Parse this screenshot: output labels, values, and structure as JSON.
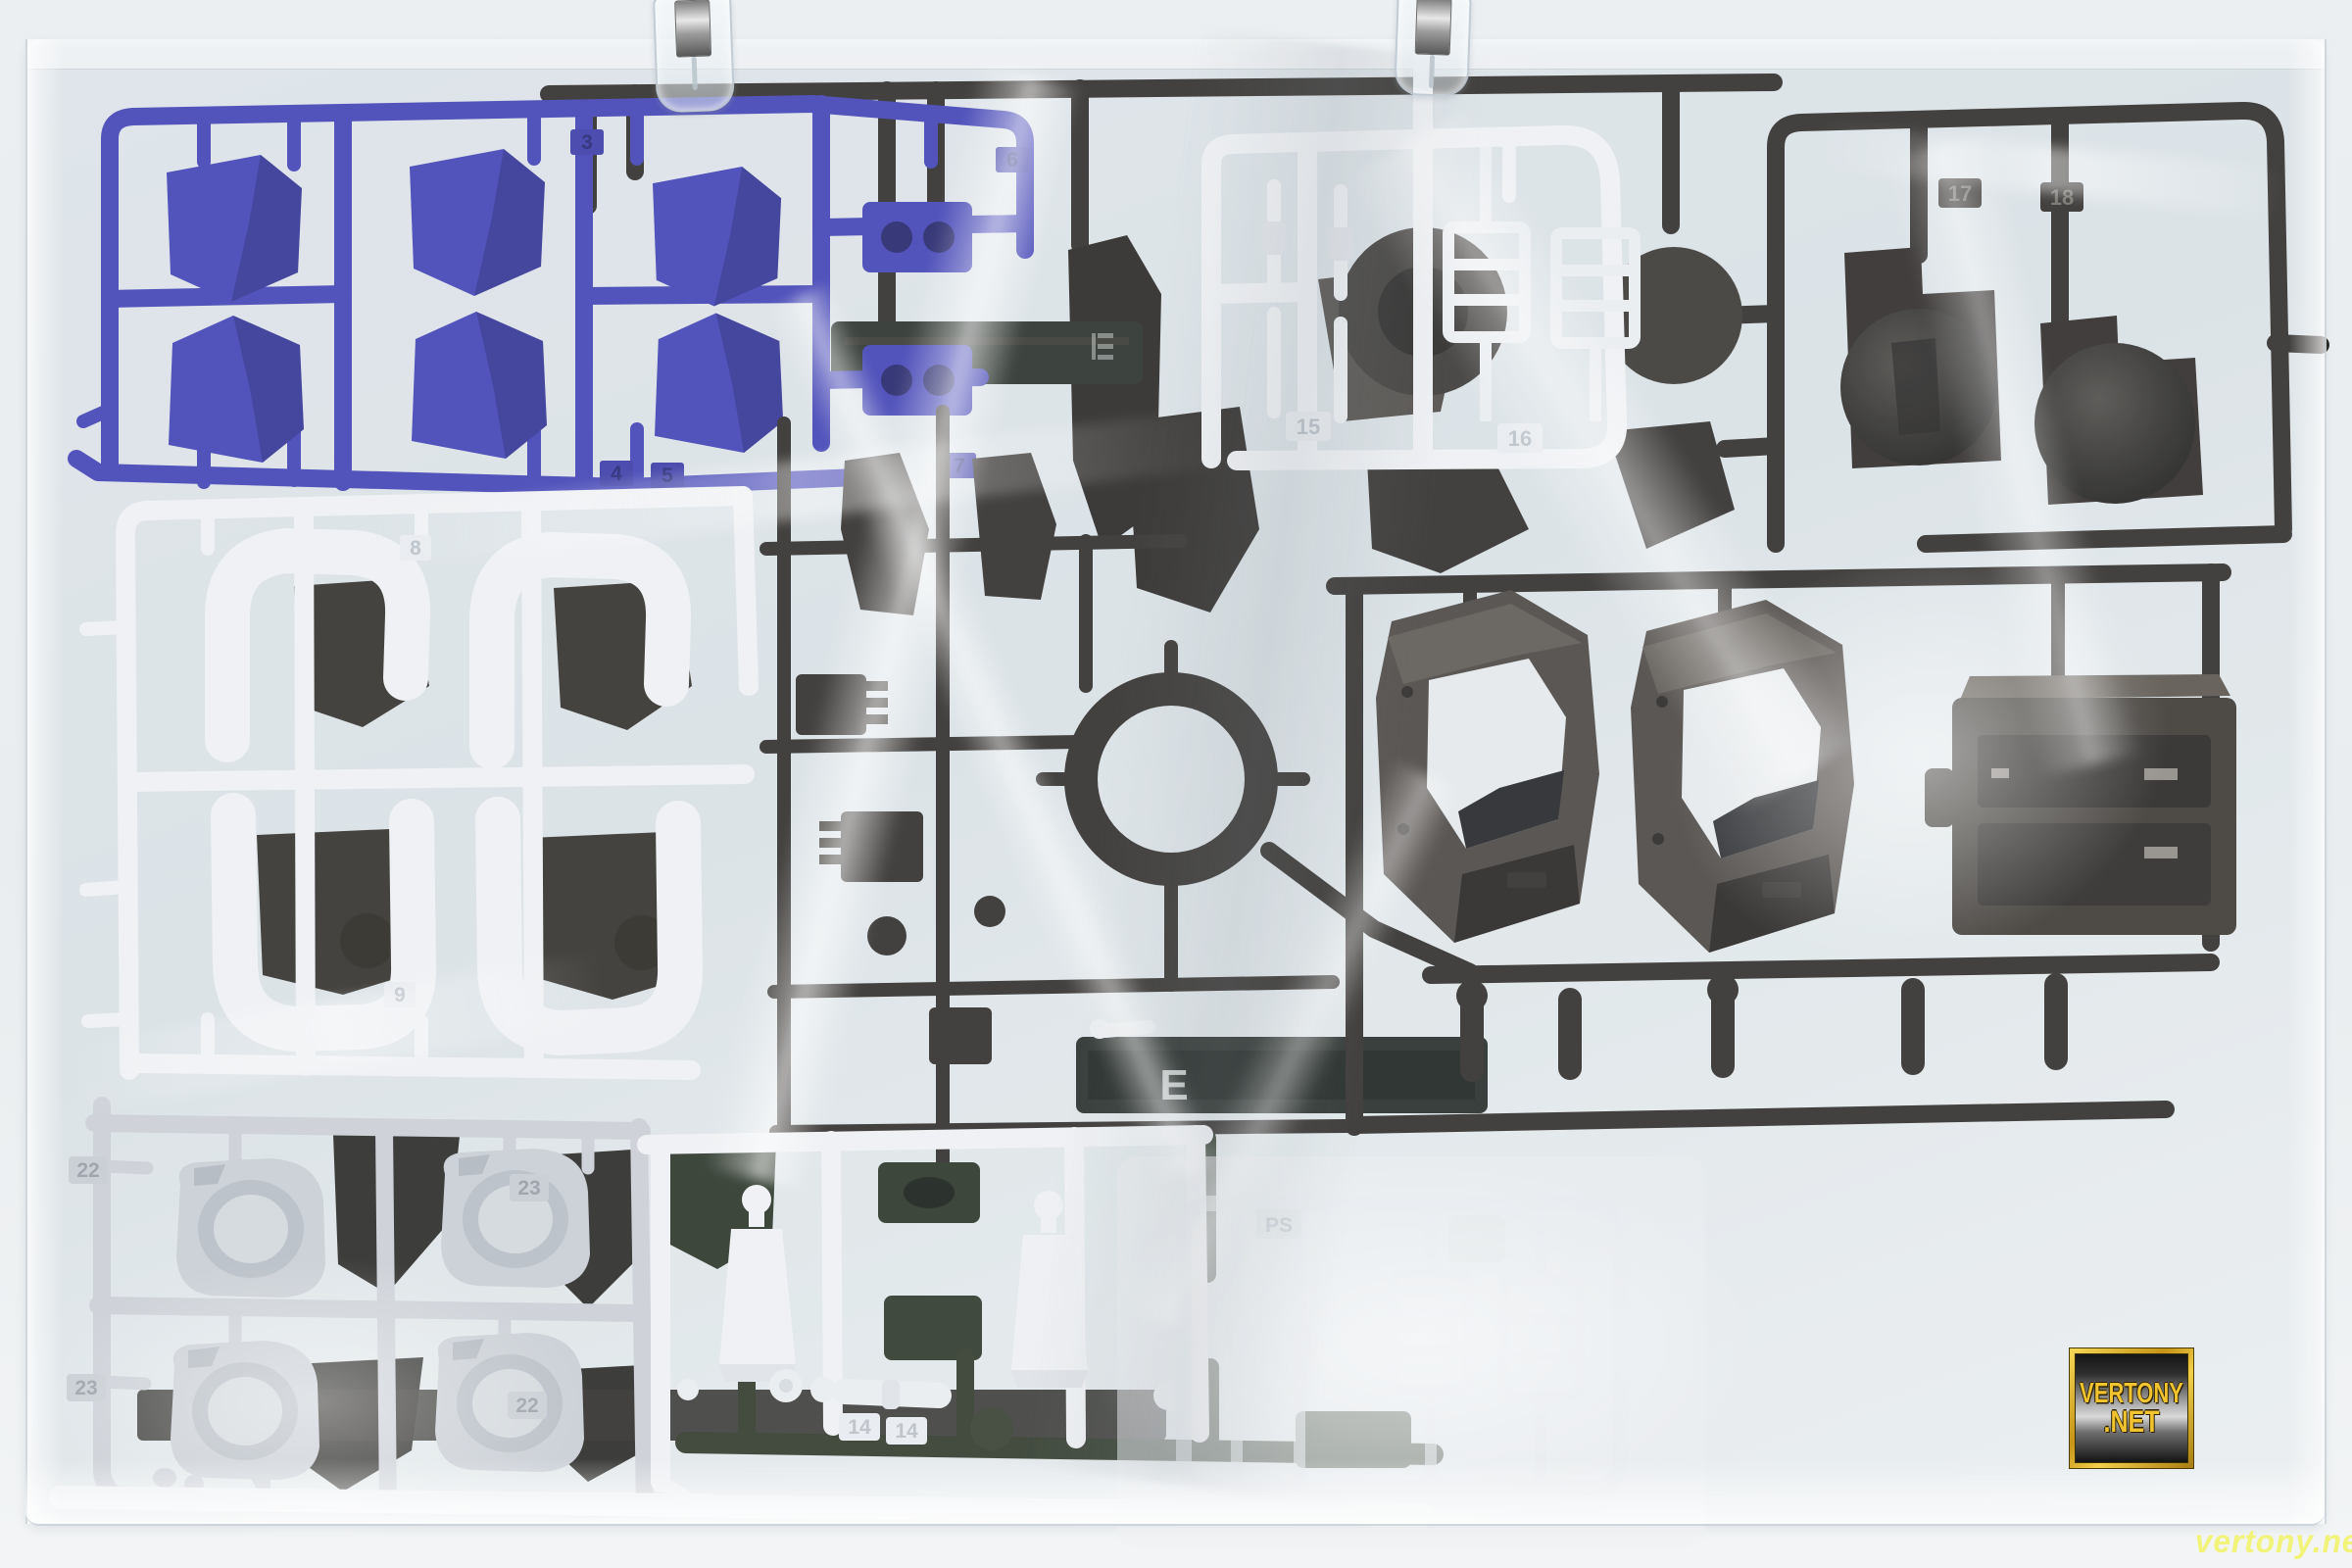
{
  "scene": {
    "type": "product-photo",
    "subject": "model-kit plastic runners sealed in a clear poly bag hung by two clips"
  },
  "palette": {
    "background": "#edf0f2",
    "bag_plastic": "#dde4e7",
    "blue_plastic": "#3c3cb4",
    "white_plastic": "#f3f4f6",
    "gray_plastic": "#cdd1d7",
    "dark_brown_plastic": "#2b2723",
    "dark_olive_plastic": "#2a3424",
    "hex_frame_face": "#46413c",
    "watermark_gold": "#f1c32e",
    "watermark_yellow": "#f3f373"
  },
  "watermark": {
    "box_line1": "VERTONY",
    "box_line2": ".NET",
    "corner_text": "vertony.net"
  },
  "runner_tags": {
    "blue": [
      "3",
      "6",
      "4",
      "5",
      "7"
    ],
    "white_top": [
      "15",
      "16"
    ],
    "dark_top_right": [
      "17",
      "18"
    ],
    "white_left": [
      "8",
      "9"
    ],
    "dark_center": [
      "E"
    ],
    "gray_bottom_left": [
      "22",
      "23",
      "23",
      "22"
    ],
    "white_bottom": [
      "14",
      "14"
    ],
    "white_bottom_right": [
      "PS"
    ]
  }
}
